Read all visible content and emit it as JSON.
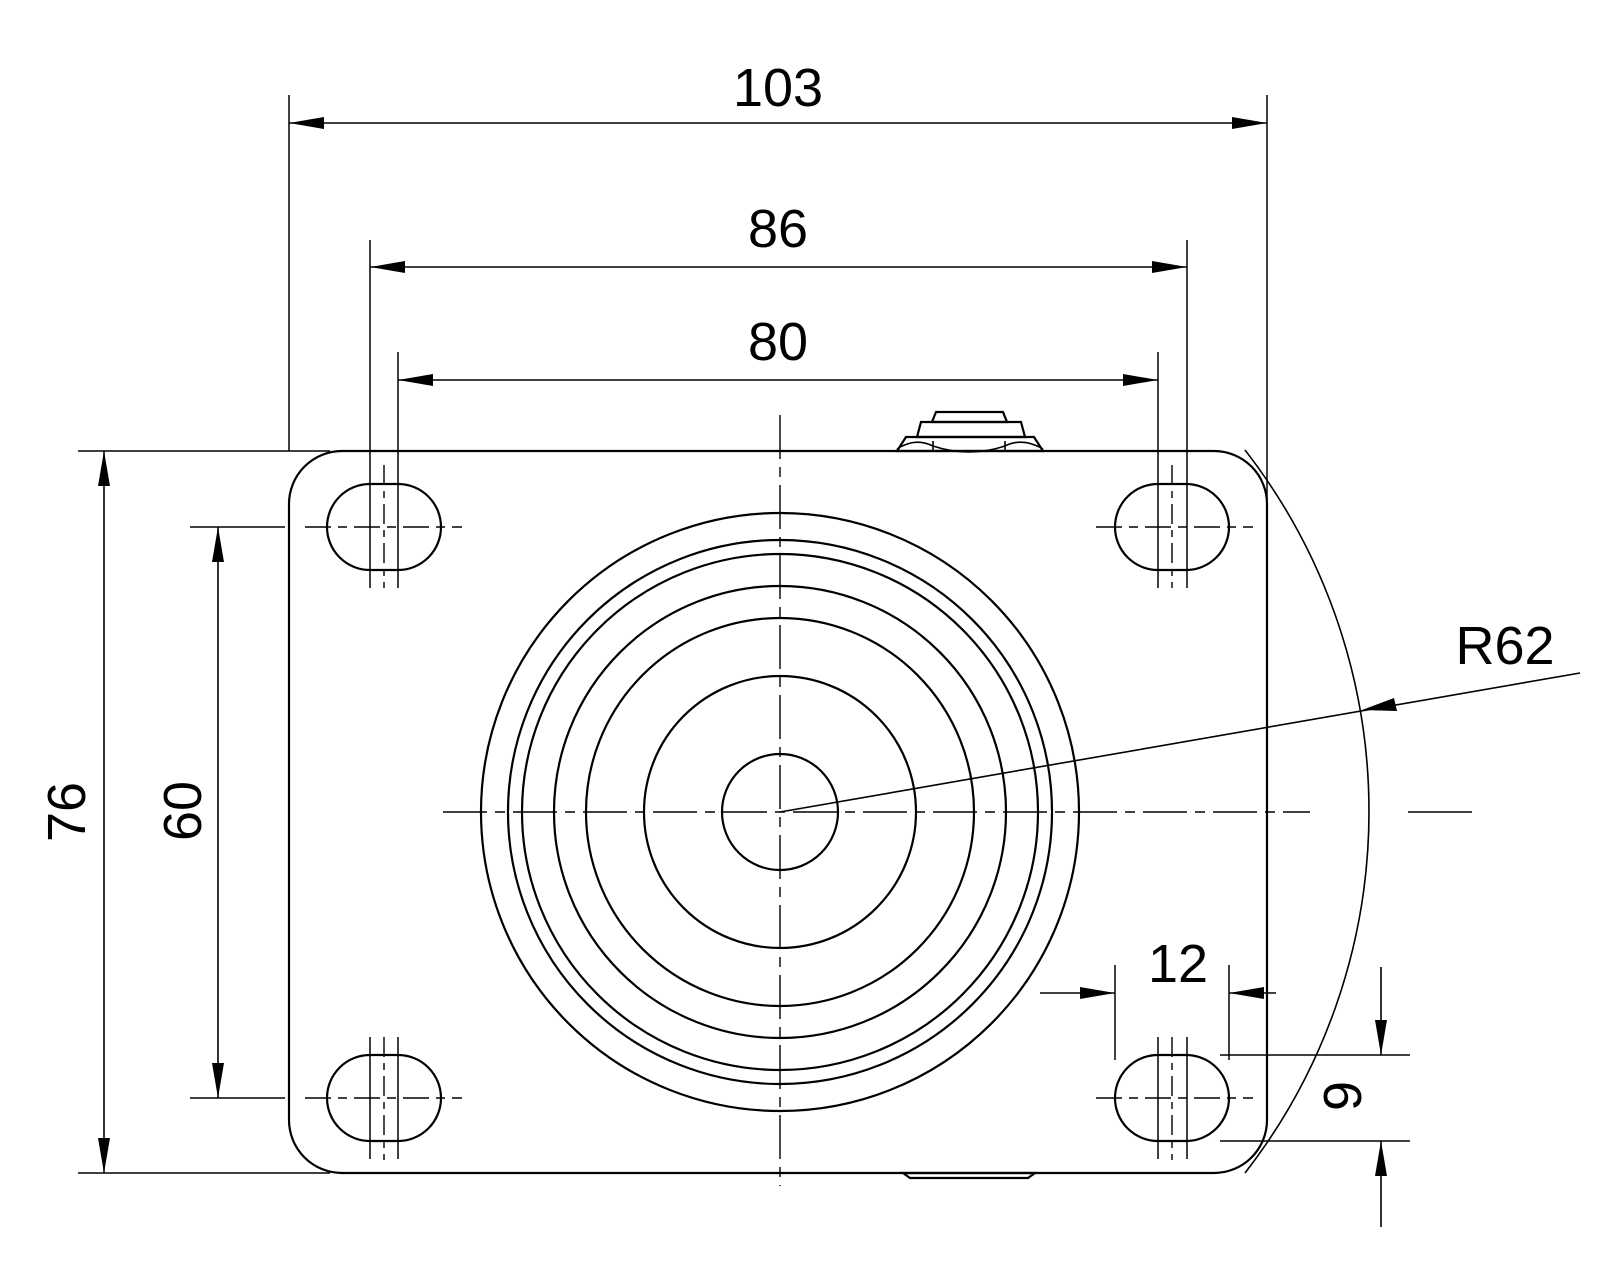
{
  "drawing": {
    "type": "technical-dimension-drawing",
    "view": "caster-plate-top-view",
    "background_color": "#ffffff",
    "line_color": "#000000",
    "dimensions": {
      "plate_width": "103",
      "bolt_spacing_outer": "86",
      "bolt_spacing_inner": "80",
      "plate_height": "76",
      "bolt_spacing_vertical": "60",
      "slot_length": "12",
      "slot_height": "9",
      "wheel_radius": "R62"
    }
  }
}
